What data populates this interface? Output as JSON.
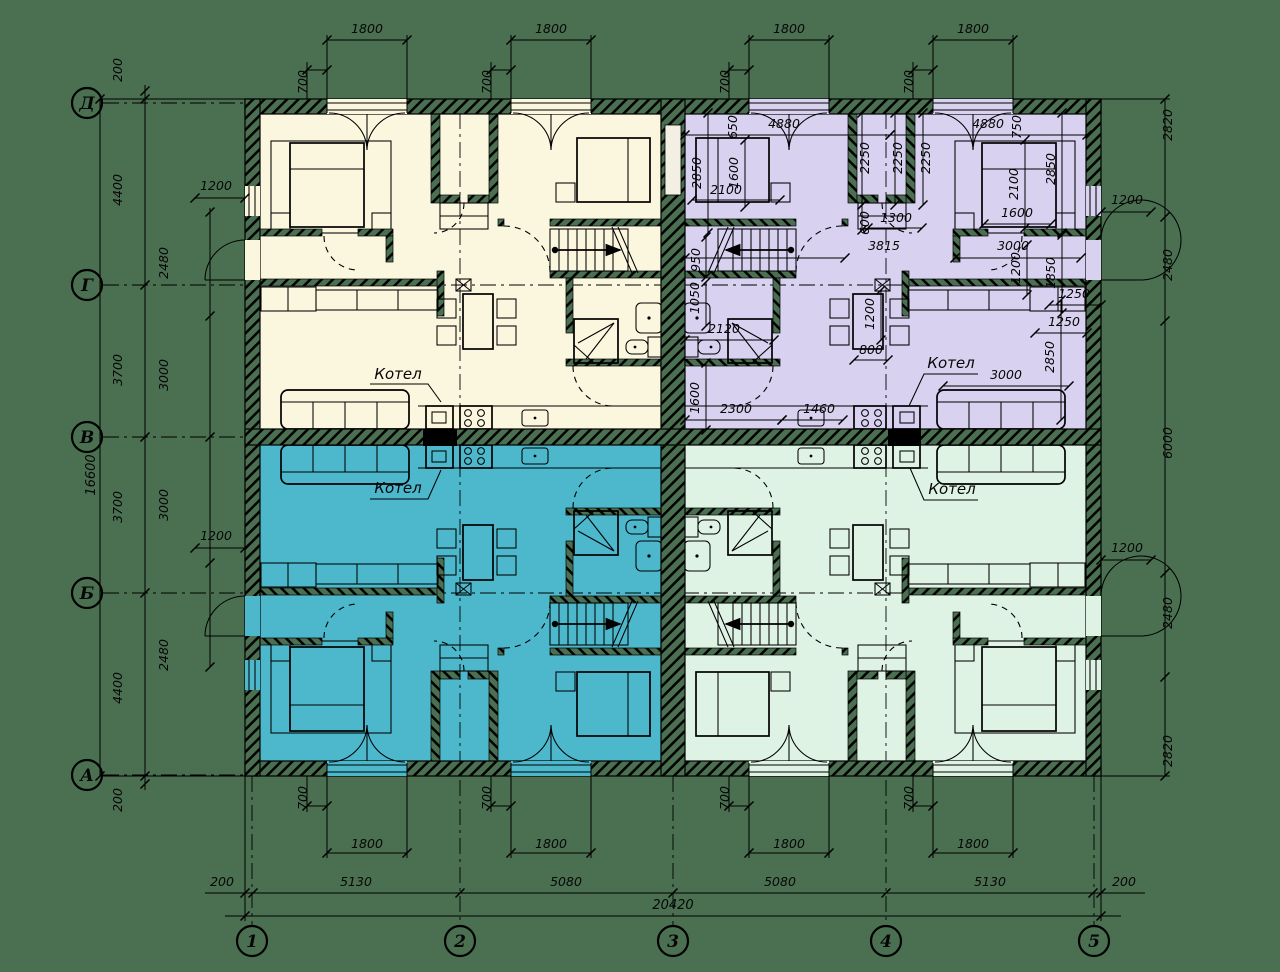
{
  "colors": {
    "background": "#4A7051",
    "unit_top_left": "#FBF6DE",
    "unit_top_right": "#D8D2F0",
    "unit_bottom_left": "#4DB8CC",
    "unit_bottom_right": "#DFF3E5",
    "line": "#000000"
  },
  "axis_rows": [
    {
      "label": "Д",
      "y": 103,
      "extend": false
    },
    {
      "label": "Г",
      "y": 285,
      "extend": true
    },
    {
      "label": "В",
      "y": 437,
      "extend": false
    },
    {
      "label": "Б",
      "y": 593,
      "extend": true
    },
    {
      "label": "А",
      "y": 775,
      "extend": false
    }
  ],
  "axis_cols": [
    {
      "label": "1",
      "x": 252,
      "extend": false
    },
    {
      "label": "2",
      "x": 460,
      "extend": true
    },
    {
      "label": "3",
      "x": 673,
      "extend": false
    },
    {
      "label": "4",
      "x": 886,
      "extend": true
    },
    {
      "label": "5",
      "x": 1094,
      "extend": false
    }
  ],
  "dim_labels": [
    {
      "t": "1800",
      "x": 367,
      "y": 33,
      "r": 0
    },
    {
      "t": "1800",
      "x": 551,
      "y": 33,
      "r": 0
    },
    {
      "t": "1800",
      "x": 789,
      "y": 33,
      "r": 0
    },
    {
      "t": "1800",
      "x": 973,
      "y": 33,
      "r": 0
    },
    {
      "t": "700",
      "x": 307,
      "y": 82,
      "r": -90
    },
    {
      "t": "700",
      "x": 491,
      "y": 82,
      "r": -90
    },
    {
      "t": "700",
      "x": 729,
      "y": 82,
      "r": -90
    },
    {
      "t": "700",
      "x": 913,
      "y": 82,
      "r": -90
    },
    {
      "t": "700",
      "x": 307,
      "y": 798,
      "r": -90
    },
    {
      "t": "700",
      "x": 491,
      "y": 798,
      "r": -90
    },
    {
      "t": "700",
      "x": 729,
      "y": 798,
      "r": -90
    },
    {
      "t": "700",
      "x": 913,
      "y": 798,
      "r": -90
    },
    {
      "t": "1800",
      "x": 367,
      "y": 848,
      "r": 0
    },
    {
      "t": "1800",
      "x": 551,
      "y": 848,
      "r": 0
    },
    {
      "t": "1800",
      "x": 789,
      "y": 848,
      "r": 0
    },
    {
      "t": "1800",
      "x": 973,
      "y": 848,
      "r": 0
    },
    {
      "t": "200",
      "x": 222,
      "y": 886,
      "r": 0
    },
    {
      "t": "5130",
      "x": 356,
      "y": 886,
      "r": 0
    },
    {
      "t": "5080",
      "x": 566,
      "y": 886,
      "r": 0
    },
    {
      "t": "5080",
      "x": 780,
      "y": 886,
      "r": 0
    },
    {
      "t": "5130",
      "x": 990,
      "y": 886,
      "r": 0
    },
    {
      "t": "200",
      "x": 1124,
      "y": 886,
      "r": 0
    },
    {
      "t": "20420",
      "x": 673,
      "y": 909,
      "r": 0
    },
    {
      "t": "16600",
      "x": 95,
      "y": 475,
      "r": -90
    },
    {
      "t": "200",
      "x": 122,
      "y": 70,
      "r": -90
    },
    {
      "t": "4400",
      "x": 122,
      "y": 190,
      "r": -90
    },
    {
      "t": "3700",
      "x": 122,
      "y": 370,
      "r": -90
    },
    {
      "t": "3700",
      "x": 122,
      "y": 507,
      "r": -90
    },
    {
      "t": "4400",
      "x": 122,
      "y": 688,
      "r": -90
    },
    {
      "t": "200",
      "x": 122,
      "y": 800,
      "r": -90
    },
    {
      "t": "2480",
      "x": 168,
      "y": 263,
      "r": -90
    },
    {
      "t": "3000",
      "x": 168,
      "y": 375,
      "r": -90
    },
    {
      "t": "3000",
      "x": 168,
      "y": 505,
      "r": -90
    },
    {
      "t": "2480",
      "x": 168,
      "y": 655,
      "r": -90
    },
    {
      "t": "1200",
      "x": 216,
      "y": 190,
      "r": 0
    },
    {
      "t": "1200",
      "x": 216,
      "y": 540,
      "r": 0
    },
    {
      "t": "2820",
      "x": 1172,
      "y": 125,
      "r": -90
    },
    {
      "t": "2480",
      "x": 1172,
      "y": 265,
      "r": -90
    },
    {
      "t": "6000",
      "x": 1172,
      "y": 443,
      "r": -90
    },
    {
      "t": "2480",
      "x": 1172,
      "y": 613,
      "r": -90
    },
    {
      "t": "2820",
      "x": 1172,
      "y": 751,
      "r": -90
    },
    {
      "t": "1200",
      "x": 1127,
      "y": 204,
      "r": 0
    },
    {
      "t": "1200",
      "x": 1127,
      "y": 552,
      "r": 0
    },
    {
      "t": "650",
      "x": 737,
      "y": 127,
      "r": -90
    },
    {
      "t": "4880",
      "x": 784,
      "y": 128,
      "r": 0
    },
    {
      "t": "4880",
      "x": 988,
      "y": 128,
      "r": 0
    },
    {
      "t": "750",
      "x": 1021,
      "y": 127,
      "r": -90
    },
    {
      "t": "2850",
      "x": 701,
      "y": 173,
      "r": -90
    },
    {
      "t": "1600",
      "x": 738,
      "y": 173,
      "r": -90
    },
    {
      "t": "2100",
      "x": 726,
      "y": 194,
      "r": 0
    },
    {
      "t": "2250",
      "x": 869,
      "y": 158,
      "r": -90
    },
    {
      "t": "2250",
      "x": 902,
      "y": 158,
      "r": -90
    },
    {
      "t": "2250",
      "x": 930,
      "y": 158,
      "r": -90
    },
    {
      "t": "2100",
      "x": 1018,
      "y": 184,
      "r": -90
    },
    {
      "t": "2850",
      "x": 1055,
      "y": 169,
      "r": -90
    },
    {
      "t": "1600",
      "x": 1017,
      "y": 217,
      "r": 0
    },
    {
      "t": "600",
      "x": 869,
      "y": 223,
      "r": -90
    },
    {
      "t": "1300",
      "x": 896,
      "y": 222,
      "r": 0
    },
    {
      "t": "3815",
      "x": 884,
      "y": 250,
      "r": 0
    },
    {
      "t": "3000",
      "x": 1013,
      "y": 250,
      "r": 0
    },
    {
      "t": "950",
      "x": 700,
      "y": 260,
      "r": -90
    },
    {
      "t": "1050",
      "x": 699,
      "y": 298,
      "r": -90
    },
    {
      "t": "1200",
      "x": 1020,
      "y": 268,
      "r": -90
    },
    {
      "t": "1850",
      "x": 1055,
      "y": 273,
      "r": -90
    },
    {
      "t": "1250",
      "x": 1074,
      "y": 298,
      "r": 0
    },
    {
      "t": "1250",
      "x": 1064,
      "y": 326,
      "r": 0
    },
    {
      "t": "2120",
      "x": 724,
      "y": 333,
      "r": 0
    },
    {
      "t": "1200",
      "x": 874,
      "y": 314,
      "r": -90
    },
    {
      "t": "800",
      "x": 871,
      "y": 354,
      "r": 0
    },
    {
      "t": "1600",
      "x": 699,
      "y": 398,
      "r": -90
    },
    {
      "t": "2300",
      "x": 736,
      "y": 413,
      "r": 0
    },
    {
      "t": "1460",
      "x": 819,
      "y": 413,
      "r": 0
    },
    {
      "t": "3000",
      "x": 1006,
      "y": 379,
      "r": 0
    },
    {
      "t": "2850",
      "x": 1054,
      "y": 357,
      "r": -90
    }
  ],
  "room_labels": [
    {
      "t": "Котел",
      "x": 398,
      "y": 379
    },
    {
      "t": "Котел",
      "x": 398,
      "y": 493
    },
    {
      "t": "Котел",
      "x": 951,
      "y": 368
    },
    {
      "t": "Котел",
      "x": 952,
      "y": 494
    }
  ]
}
